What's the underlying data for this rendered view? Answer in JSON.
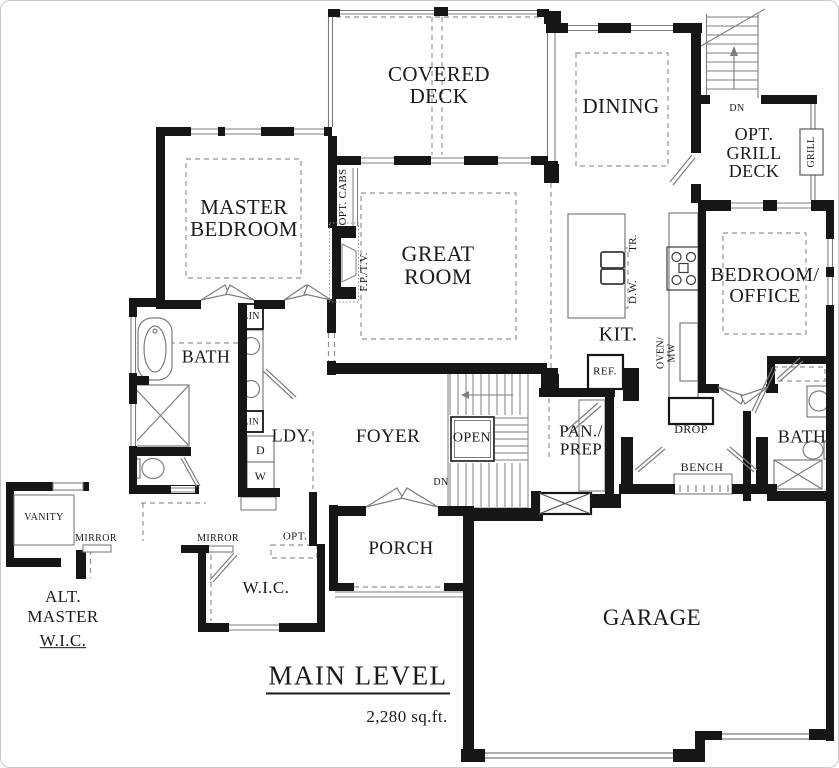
{
  "title_block": {
    "title": "MAIN LEVEL",
    "area": "2,280 sq.ft."
  },
  "rooms": {
    "covered_deck": "COVERED\nDECK",
    "dining": "DINING",
    "opt_grill_deck": "OPT.\nGRILL\nDECK",
    "master_bedroom": "MASTER\nBEDROOM",
    "great_room": "GREAT\nROOM",
    "kitchen": "KIT.",
    "bedroom_office": "BEDROOM/\nOFFICE",
    "master_bath": "BATH",
    "laundry": "LDY.",
    "foyer": "FOYER",
    "pantry_prep": "PAN./\nPREP",
    "bath2": "BATH",
    "wic": "W.I.C.",
    "porch": "PORCH",
    "garage": "GARAGE",
    "alt_master_wic": {
      "line1": "ALT.",
      "line2": "MASTER",
      "line3": "W.I.C."
    }
  },
  "annotations": {
    "dn_exterior": "DN",
    "dn_stairs": "DN",
    "open_stairwell": "OPEN",
    "grill": "GRILL",
    "opt_cabs": "OPT. CABS",
    "fireplace_tv": "F.P./T.V.",
    "trash": "TR.",
    "dishwasher": "D.W.",
    "oven_microwave": "OVEN/\nMW",
    "refrigerator": "REF.",
    "linen_top": "LIN",
    "linen_bottom": "LIN",
    "dryer": "D",
    "washer": "W",
    "drop": "DROP",
    "bench": "BENCH",
    "vanity": "VANITY",
    "mirror_left": "MIRROR",
    "mirror_right": "MIRROR",
    "opt_wic": "OPT."
  },
  "colors": {
    "wall": "#161616",
    "thin_line": "#7d7d7d",
    "dashed_line": "#949494",
    "text": "#1a1a1a",
    "background": "#ffffff"
  }
}
